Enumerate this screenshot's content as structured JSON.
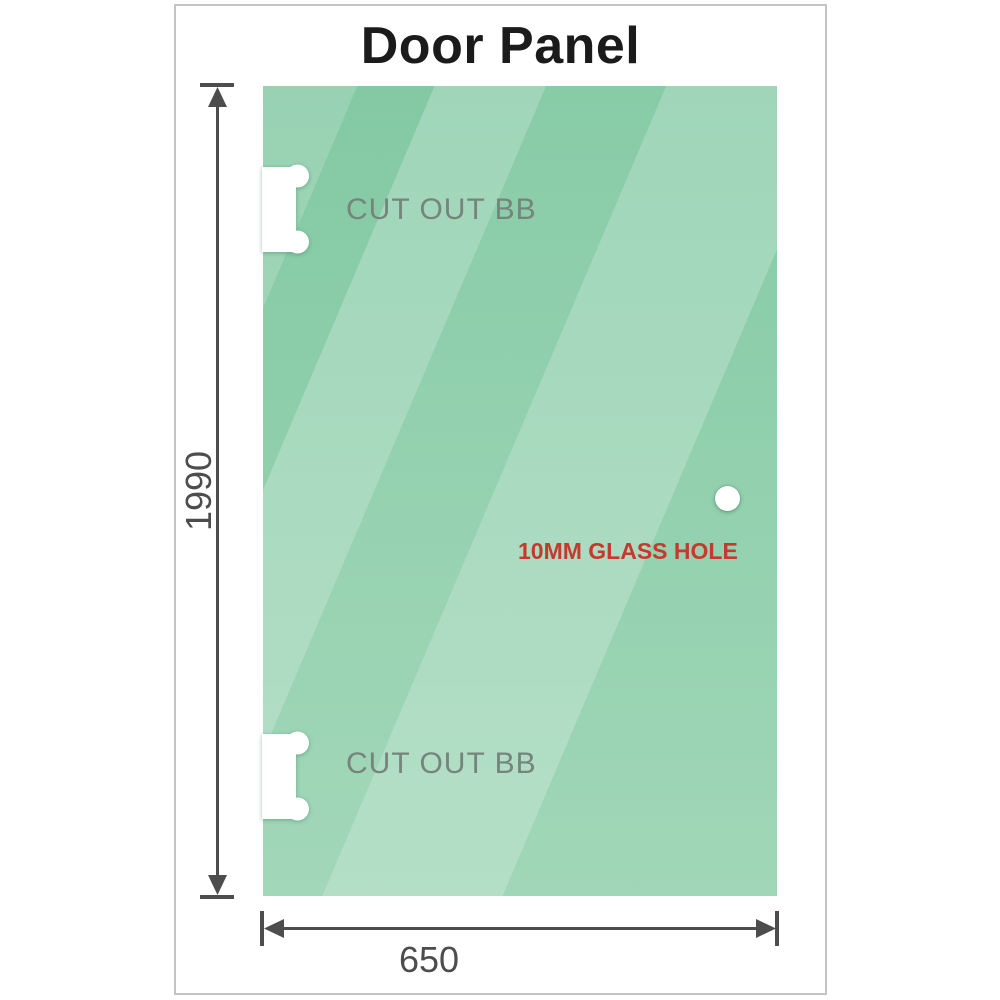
{
  "title": "Door Panel",
  "panel": {
    "cutout_top_label": "CUT OUT BB",
    "cutout_bottom_label": "CUT OUT BB",
    "hole_label": "10MM GLASS HOLE"
  },
  "dimensions": {
    "height_label": "1990",
    "width_label": "650"
  },
  "colors": {
    "glass_green_top": "#7ec7a0",
    "glass_green_bottom": "#9ad4b3",
    "cutout_label_gray": "#76847c",
    "hole_label_red": "#c63a2d",
    "dimension_gray": "#4d4d4d",
    "frame_border": "#c4c4c4",
    "title_black": "#1b1b1b"
  }
}
